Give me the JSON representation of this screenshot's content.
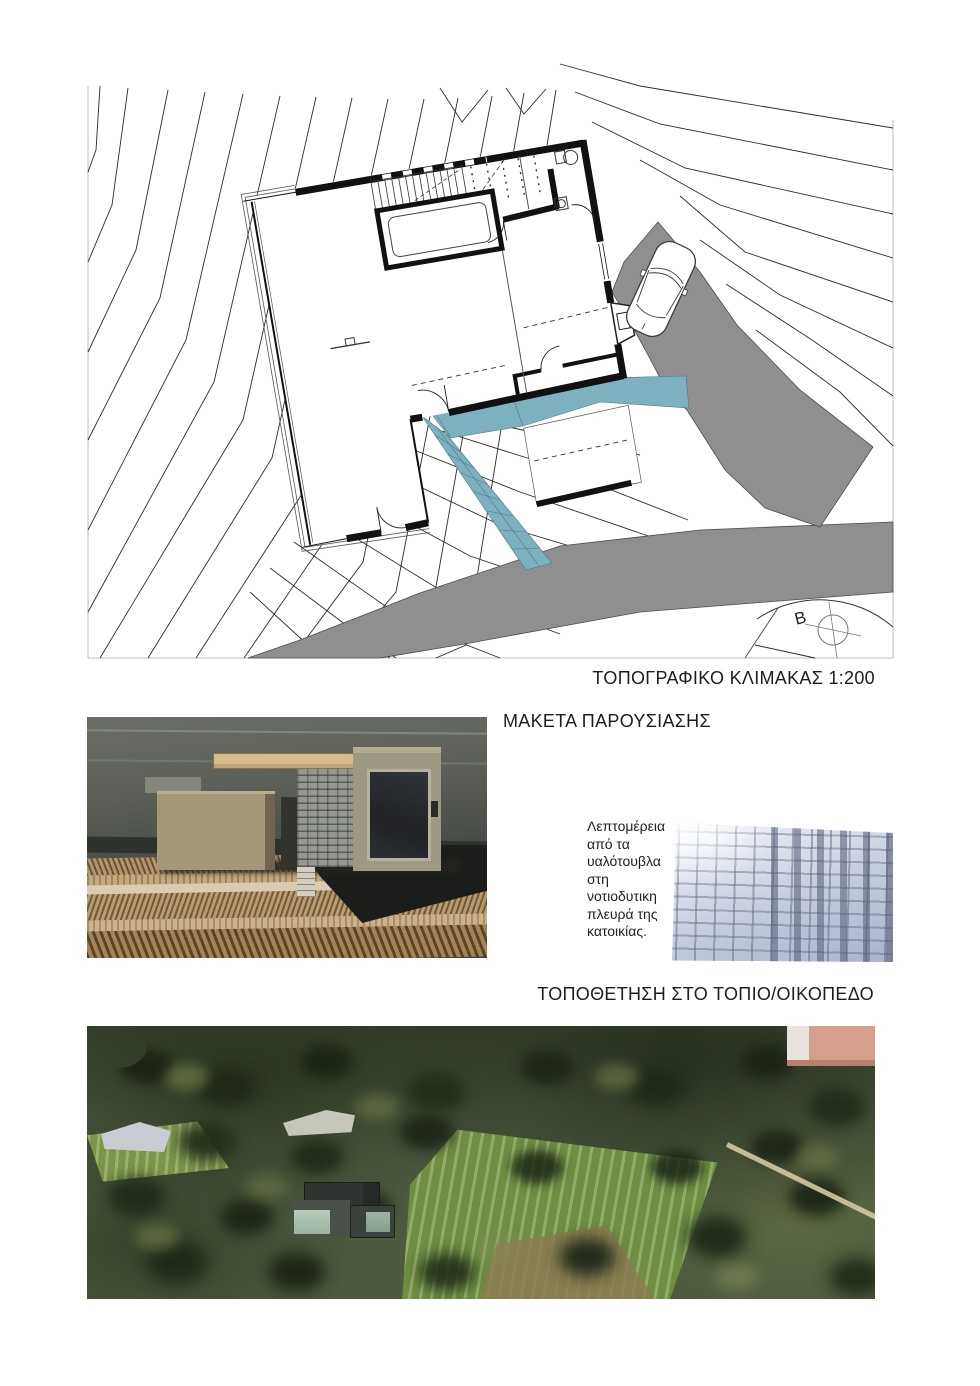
{
  "topo_plan": {
    "title": "ΤΟΠΟΓΡΑΦΙΚΟ ΚΛΙΜΑΚΑΣ 1:200",
    "north_label": "B",
    "road_color": "#8f8f8f",
    "walkway_color": "#7eb1c0"
  },
  "model": {
    "title": "ΜΑΚΕΤΑ ΠΑΡΟΥΣΙΑΣΗΣ"
  },
  "glass_detail": {
    "caption": "Λεπτομέρεια\nαπό τα\nυαλότουβλα\nστη\nνοτιοδυτικη\nπλευρά της\nκατοικίας."
  },
  "siting": {
    "title": "ΤΟΠΟΘΕΤΗΣΗ ΣΤΟ ΤΟΠΙΟ/ΟΙΚΟΠΕΔΟ"
  }
}
